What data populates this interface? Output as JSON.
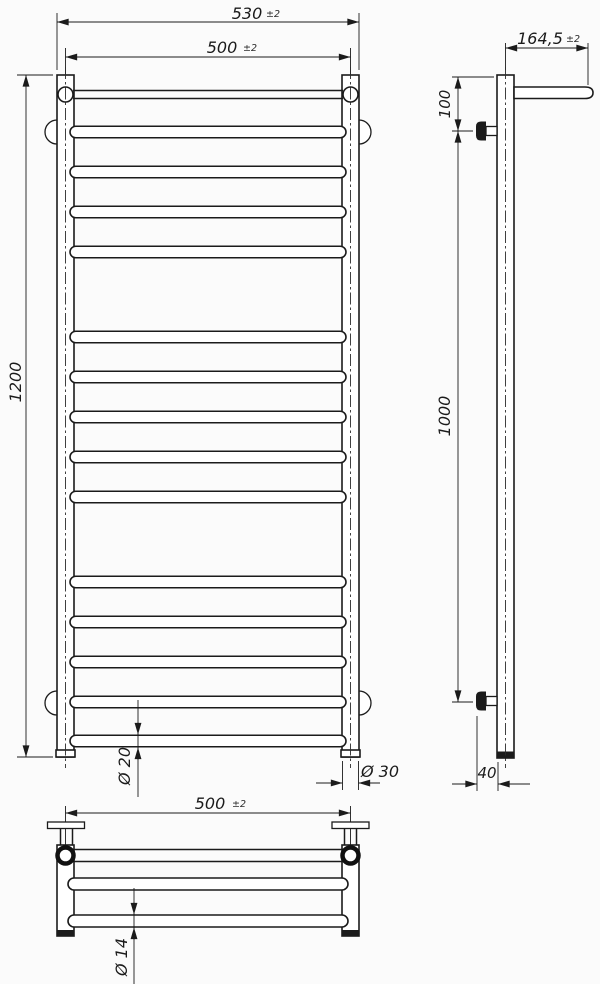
{
  "drawing": {
    "kind": "technical-drawing-three-views",
    "labels": {
      "front": {
        "width_outer": "530",
        "width_outer_tol": "±2",
        "width_inner": "500",
        "width_inner_tol": "±2",
        "height": "1200",
        "rung_diameter": "Ø 20",
        "post_diameter": "Ø 30",
        "bottom_width": "500",
        "bottom_width_tol": "±2"
      },
      "side": {
        "depth": "164,5",
        "depth_tol": "±2",
        "top_offset": "100",
        "bracket_span": "1000",
        "wall_offset": "40"
      },
      "bottom": {
        "tube_diameter": "Ø 14"
      }
    },
    "geometry": {
      "front_rungs_y": [
        132,
        172,
        212,
        252,
        337,
        377,
        417,
        457,
        497,
        582,
        622,
        662,
        702,
        741
      ],
      "bottom_tubes_y": [
        884,
        921
      ]
    },
    "colors": {
      "line": "#1b1b1b",
      "background": "#fbfbfb"
    }
  }
}
